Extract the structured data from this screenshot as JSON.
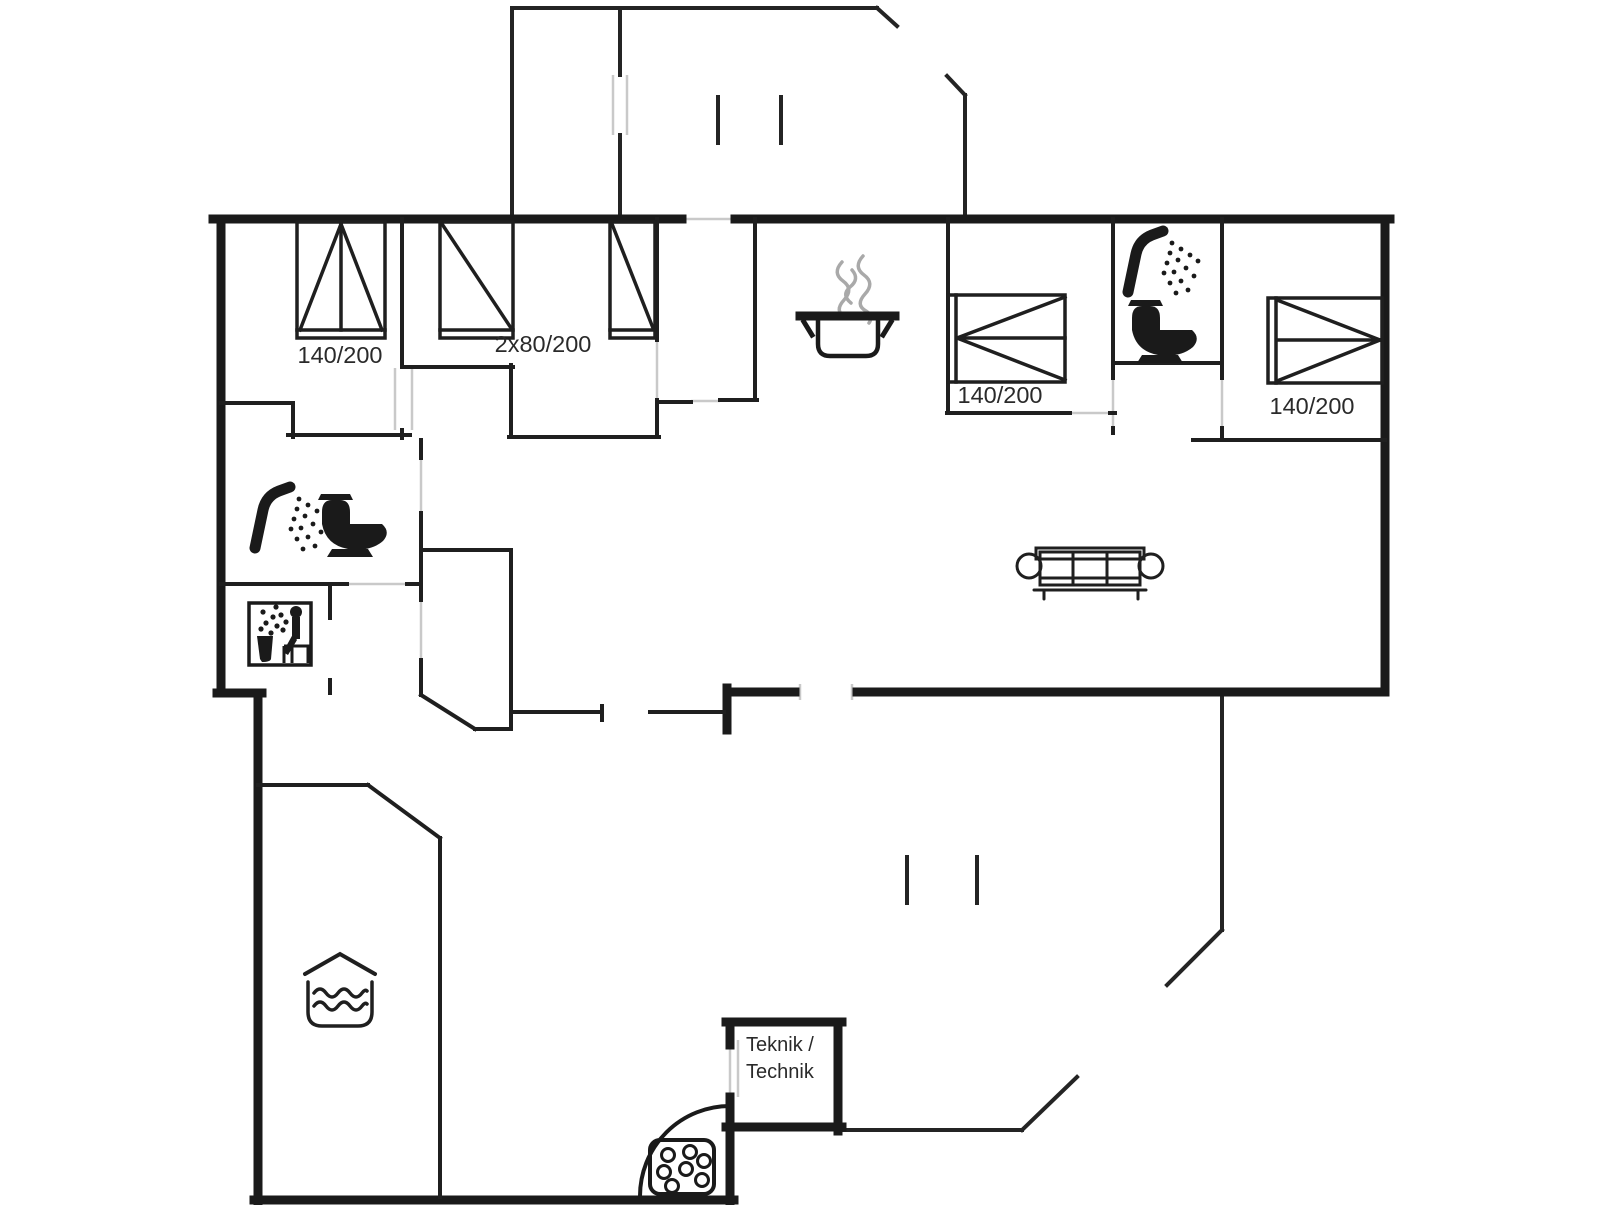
{
  "title": "Holiday house floor plan",
  "colors": {
    "wall": "#1a1a1a",
    "thin_wall": "#1f1f1f",
    "terrace_line": "#242424",
    "door_mark": "#c9c9c9",
    "steam": "#a9a9a9",
    "text": "#2a2a2a",
    "background": "#ffffff"
  },
  "rooms": {
    "bedroom_1": {
      "bed_label": "140/200"
    },
    "bedroom_2": {
      "bed_label": "2x80/200"
    },
    "bedroom_3": {
      "bed_label": "140/200"
    },
    "bedroom_4": {
      "bed_label": "140/200"
    },
    "technical_room": {
      "label_line1": "Teknik /",
      "label_line2": "Technik"
    }
  },
  "icons": {
    "cooking_pot": "cooking-pot-with-steam",
    "shower_1": "shower-head-spray",
    "toilet_1": "toilet-side-view",
    "shower_2": "shower-head-spray",
    "toilet_2": "toilet-side-view",
    "sauna": "sauna-person-steam-bucket",
    "sofa": "three-seat-sofa-top-view",
    "pool": "whirlpool-roof-waves",
    "stove": "stove-stone-basket"
  }
}
